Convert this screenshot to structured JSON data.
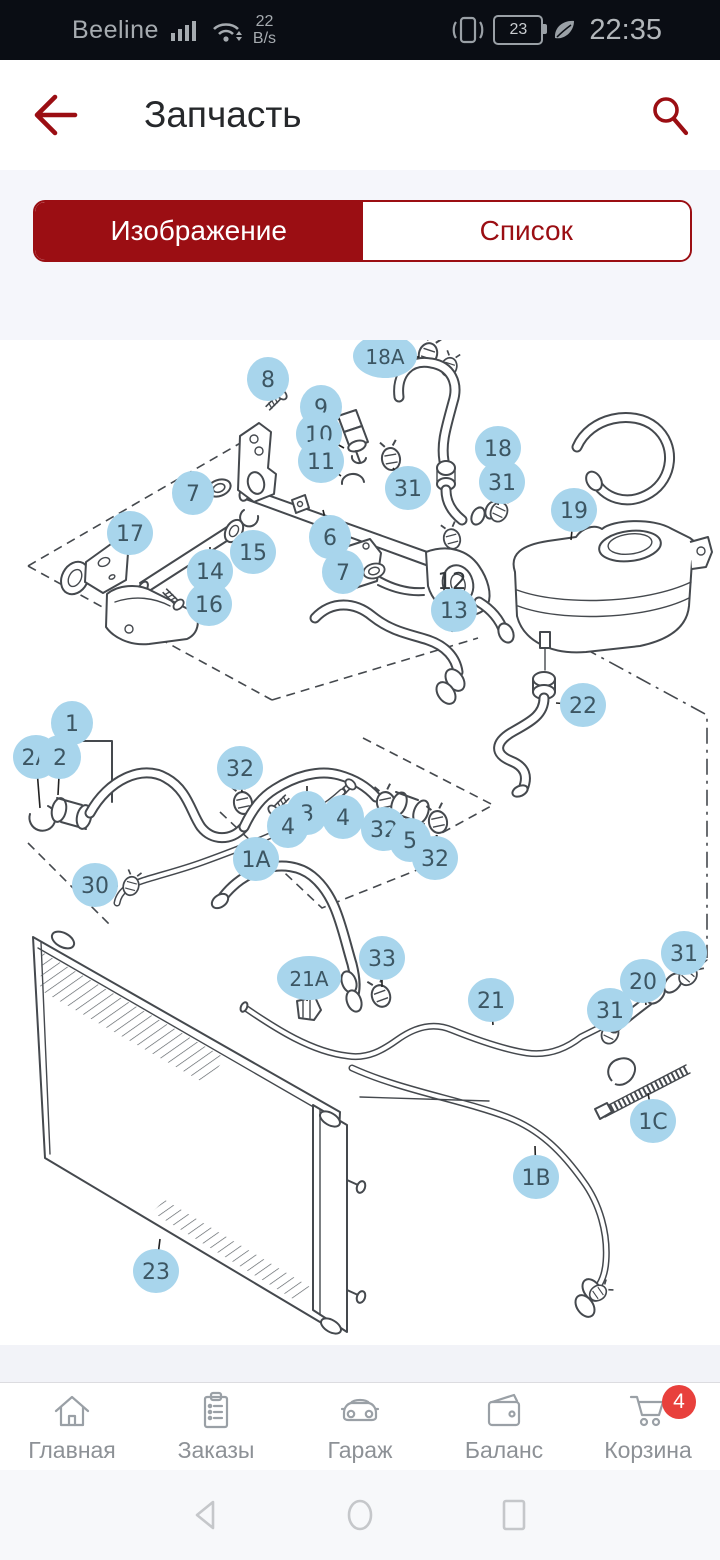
{
  "status_bar": {
    "carrier": "Beeline",
    "net_speed_value": "22",
    "net_speed_unit": "B/s",
    "battery_level": "23",
    "time": "22:35"
  },
  "header": {
    "title": "Запчасть"
  },
  "tabs": {
    "image_tab": "Изображение",
    "list_tab": "Список",
    "active": "Изображение"
  },
  "diagram": {
    "plain_labels": [
      {
        "l": "12",
        "x": 452,
        "y": 249
      }
    ],
    "callouts": [
      {
        "l": "8",
        "x": 268,
        "y": 39,
        "lx": 277,
        "ly": 57
      },
      {
        "l": "18A",
        "x": 385,
        "y": 16,
        "lx": 419,
        "ly": 17
      },
      {
        "l": "9",
        "x": 321,
        "y": 67,
        "lx": 340,
        "ly": 80
      },
      {
        "l": "10",
        "x": 319,
        "y": 94,
        "lx": 344,
        "ly": 108
      },
      {
        "l": "11",
        "x": 321,
        "y": 121,
        "lx": 341,
        "ly": 136
      },
      {
        "l": "31",
        "x": 408,
        "y": 148,
        "lx": 393,
        "ly": 128
      },
      {
        "l": "18",
        "x": 498,
        "y": 108,
        "lx": 476,
        "ly": 106
      },
      {
        "l": "31",
        "x": 502,
        "y": 142,
        "lx": 498,
        "ly": 165
      },
      {
        "l": "19",
        "x": 574,
        "y": 170,
        "lx": 571,
        "ly": 200
      },
      {
        "l": "7",
        "x": 193,
        "y": 153,
        "lx": 208,
        "ly": 150
      },
      {
        "l": "17",
        "x": 130,
        "y": 193,
        "lx": 122,
        "ly": 207
      },
      {
        "l": "15",
        "x": 253,
        "y": 212,
        "lx": 250,
        "ly": 191
      },
      {
        "l": "14",
        "x": 210,
        "y": 231,
        "lx": 210,
        "ly": 207
      },
      {
        "l": "16",
        "x": 209,
        "y": 264,
        "lx": 190,
        "ly": 262
      },
      {
        "l": "6",
        "x": 330,
        "y": 197,
        "lx": 323,
        "ly": 170
      },
      {
        "l": "7",
        "x": 343,
        "y": 232,
        "lx": 362,
        "ly": 232
      },
      {
        "l": "13",
        "x": 454,
        "y": 270,
        "lx": 452,
        "ly": 292
      },
      {
        "l": "22",
        "x": 583,
        "y": 365,
        "lx": 556,
        "ly": 363
      },
      {
        "l": "1",
        "x": 72,
        "y": 383,
        "lx": 72,
        "ly": 400
      },
      {
        "l": "2A",
        "x": 36,
        "y": 417,
        "lx": 40,
        "ly": 468
      },
      {
        "l": "2",
        "x": 60,
        "y": 417,
        "lx": 58,
        "ly": 455
      },
      {
        "l": "32",
        "x": 240,
        "y": 428,
        "lx": 242,
        "ly": 452
      },
      {
        "l": "3",
        "x": 307,
        "y": 473,
        "lx": 307,
        "ly": 446
      },
      {
        "l": "4",
        "x": 288,
        "y": 486,
        "lx": 280,
        "ly": 470
      },
      {
        "l": "4",
        "x": 343,
        "y": 477,
        "lx": 348,
        "ly": 456
      },
      {
        "l": "32",
        "x": 384,
        "y": 489,
        "lx": 386,
        "ly": 468
      },
      {
        "l": "5",
        "x": 410,
        "y": 500,
        "lx": 409,
        "ly": 479
      },
      {
        "l": "32",
        "x": 435,
        "y": 518,
        "lx": 437,
        "ly": 495
      },
      {
        "l": "30",
        "x": 95,
        "y": 545,
        "lx": 118,
        "ly": 546
      },
      {
        "l": "1A",
        "x": 256,
        "y": 519,
        "lx": 249,
        "ly": 540
      },
      {
        "l": "21A",
        "x": 309,
        "y": 638,
        "lx": 307,
        "ly": 661
      },
      {
        "l": "33",
        "x": 382,
        "y": 618,
        "lx": 382,
        "ly": 647
      },
      {
        "l": "21",
        "x": 491,
        "y": 660,
        "lx": 493,
        "ly": 685
      },
      {
        "l": "31",
        "x": 610,
        "y": 670,
        "lx": 610,
        "ly": 689
      },
      {
        "l": "20",
        "x": 643,
        "y": 641,
        "lx": 646,
        "ly": 665
      },
      {
        "l": "31",
        "x": 684,
        "y": 613,
        "lx": 686,
        "ly": 630
      },
      {
        "l": "1C",
        "x": 653,
        "y": 781,
        "lx": 648,
        "ly": 753
      },
      {
        "l": "1B",
        "x": 536,
        "y": 837,
        "lx": 535,
        "ly": 806
      },
      {
        "l": "23",
        "x": 156,
        "y": 931,
        "lx": 160,
        "ly": 899
      }
    ]
  },
  "bottom_nav": {
    "items": [
      {
        "label": "Главная",
        "icon": "home-icon"
      },
      {
        "label": "Заказы",
        "icon": "orders-icon"
      },
      {
        "label": "Гараж",
        "icon": "garage-icon"
      },
      {
        "label": "Баланс",
        "icon": "balance-icon"
      },
      {
        "label": "Корзина",
        "icon": "cart-icon"
      }
    ],
    "cart_badge": "4"
  },
  "colors": {
    "accent_red": "#9b0e13",
    "callout_blue": "#a8d5ec",
    "badge_red": "#e8403c"
  }
}
